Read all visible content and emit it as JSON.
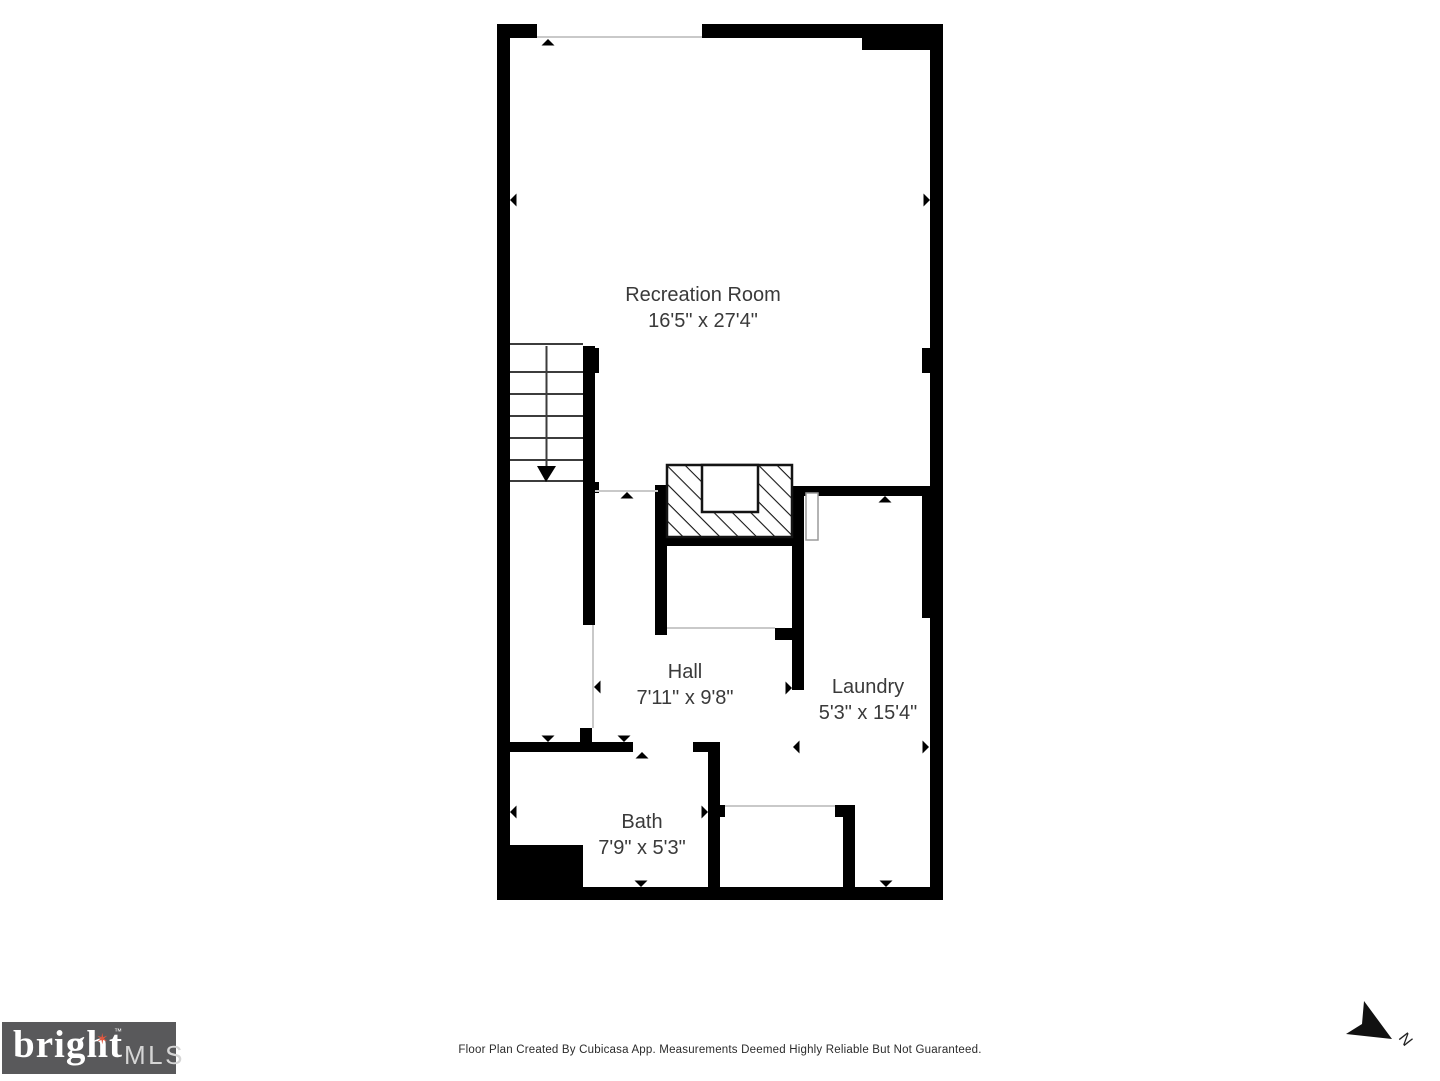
{
  "plan": {
    "rooms": [
      {
        "name": "Recreation Room",
        "dims": "16'5\" x 27'4\""
      },
      {
        "name": "Hall",
        "dims": "7'11\" x 9'8\""
      },
      {
        "name": "Laundry",
        "dims": "5'3\" x 15'4\""
      },
      {
        "name": "Bath",
        "dims": "7'9\" x 5'3\""
      }
    ],
    "compass_label": "N"
  },
  "footer": {
    "disclaimer": "Floor Plan Created By Cubicasa App. Measurements Deemed Highly Reliable But Not Guaranteed."
  },
  "logo": {
    "brand": "bright",
    "trademark": "™",
    "suffix": "MLS"
  },
  "colors": {
    "wall": "#000000",
    "room_text": "#3a3a3a",
    "thin_line": "#c9c9c9",
    "logo_bg": "#59595b",
    "logo_star": "#e0583f",
    "logo_mls": "#d5d5d5"
  }
}
